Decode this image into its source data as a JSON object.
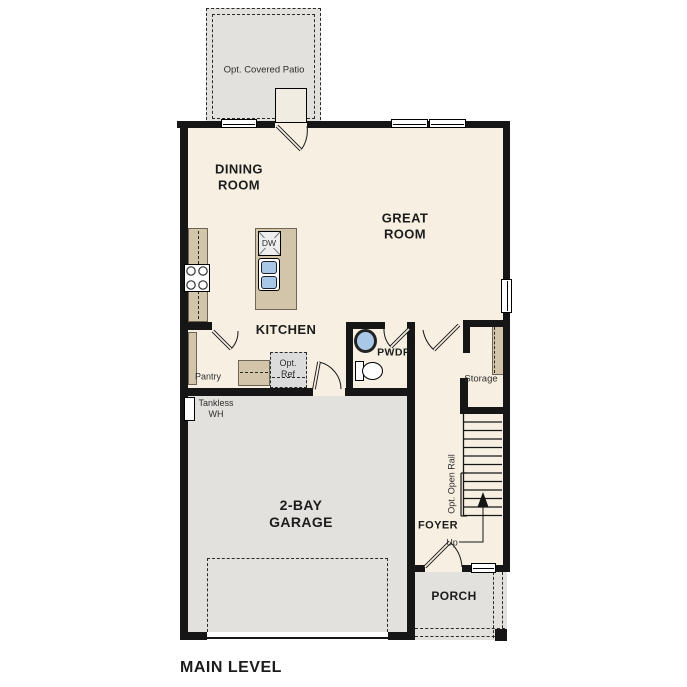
{
  "plan": {
    "title": "MAIN LEVEL",
    "rooms": {
      "patio": "Opt. Covered Patio",
      "dining": "DINING\nROOM",
      "great": "GREAT\nROOM",
      "kitchen": "KITCHEN",
      "powder": "PWDR",
      "pantry": "Pantry",
      "storage": "Storage",
      "garage": "2-BAY\nGARAGE",
      "foyer": "FOYER",
      "porch": "PORCH"
    },
    "annotations": {
      "opt_ref": "Opt.\nRef",
      "tankless": "Tankless\nWH",
      "up": "Up",
      "open_rail": "Opt. Open Rail",
      "dishwasher": "DW"
    },
    "colors": {
      "floor": "#f7f0e2",
      "outdoor": "#e2e1de",
      "cabinet": "#d2c5a9",
      "wall": "#161616",
      "fixture_blue": "#a9c8e8",
      "optional_fill": "#dcdcdc",
      "line": "#1c1c1c"
    }
  }
}
